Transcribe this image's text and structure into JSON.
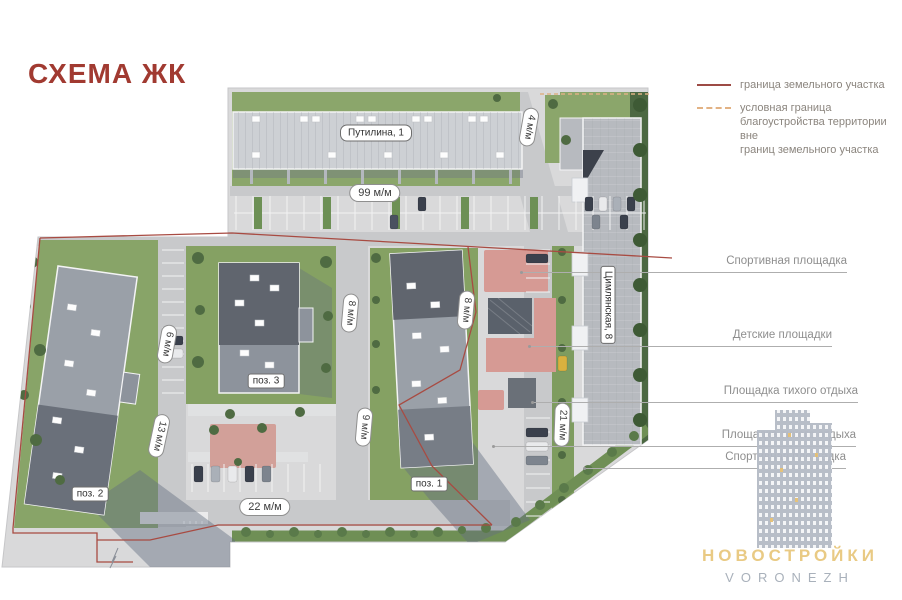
{
  "title": "СХЕМА ЖК",
  "legend": {
    "items": [
      {
        "label": "граница земельного участка",
        "line_color": "#9d4b45",
        "style": "solid"
      },
      {
        "label": "условная граница\nблагоустройства территории вне\nграниц земельного участка",
        "line_color": "#e2b284",
        "style": "dashed"
      }
    ]
  },
  "callouts": [
    {
      "label": "Спортивная площадка"
    },
    {
      "label": "Детские площадки"
    },
    {
      "label": "Площадка тихого отдыха"
    },
    {
      "label": "Площадка тихого отдыха"
    },
    {
      "label": "Спортивная площадка"
    }
  ],
  "map": {
    "buildings": [
      {
        "label": "Путилина, 1"
      },
      {
        "label": "Цимлянская, 8"
      },
      {
        "label": "поз. 3"
      },
      {
        "label": "поз. 1"
      },
      {
        "label": "поз. 2"
      }
    ],
    "distances": [
      "99 м/м",
      "4 м/м",
      "6 м/м",
      "8 м/м",
      "8 м/м",
      "13 м/м",
      "9 м/м",
      "21 м/м",
      "22 м/м"
    ]
  },
  "watermark": {
    "brand": "НОВОСТРОЙКИ",
    "city": "VORONEZH"
  },
  "colors": {
    "title_red": "#a13a31",
    "boundary_red": "#a84b42",
    "conditional_boundary_orange": "#e2b284",
    "grass_green": "#87a368",
    "pavement_gray": "#d9d9da",
    "roof_dark_gray": "#61666f",
    "playground_pink": "#d69a94",
    "watermark_gold": "#e9ca84",
    "watermark_gray": "#a9b1bb"
  }
}
